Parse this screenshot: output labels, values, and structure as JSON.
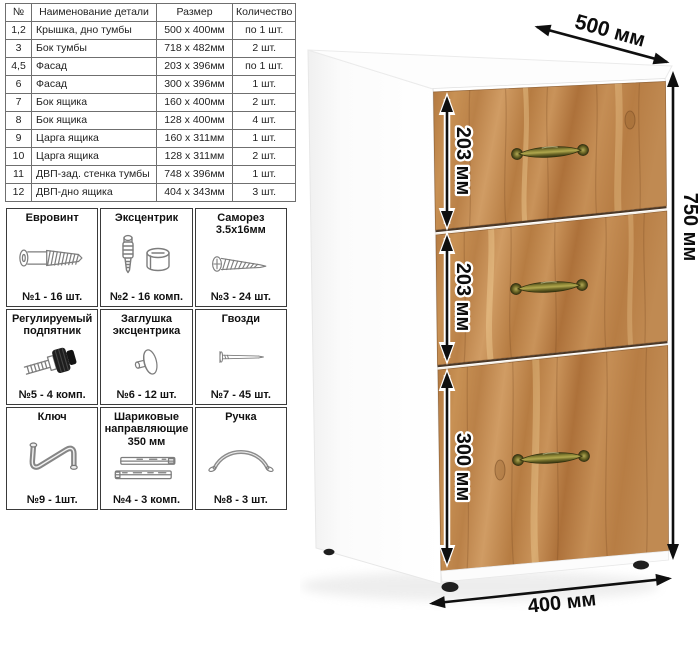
{
  "parts_table": {
    "headers": [
      "№",
      "Наименование детали",
      "Размер",
      "Количество"
    ],
    "rows": [
      [
        "1,2",
        "Крышка, дно тумбы",
        "500 х 400мм",
        "по 1 шт."
      ],
      [
        "3",
        "Бок тумбы",
        "718 х 482мм",
        "2 шт."
      ],
      [
        "4,5",
        "Фасад",
        "203 х 396мм",
        "по 1 шт."
      ],
      [
        "6",
        "Фасад",
        "300 х 396мм",
        "1 шт."
      ],
      [
        "7",
        "Бок ящика",
        "160 х 400мм",
        "2 шт."
      ],
      [
        "8",
        "Бок ящика",
        "128 х 400мм",
        "4 шт."
      ],
      [
        "9",
        "Царга ящика",
        "160 х 311мм",
        "1 шт."
      ],
      [
        "10",
        "Царга ящика",
        "128 х 311мм",
        "2 шт."
      ],
      [
        "11",
        "ДВП-зад. стенка тумбы",
        "748 х 396мм",
        "1 шт."
      ],
      [
        "12",
        "ДВП-дно ящика",
        "404 х 343мм",
        "3 шт."
      ]
    ]
  },
  "hardware": {
    "items": [
      {
        "title": "Евровинт",
        "count": "№1 - 16 шт.",
        "icon": "euro-screw-icon"
      },
      {
        "title": "Эксцентрик",
        "count": "№2 - 16 комп.",
        "icon": "eccentric-cam-icon"
      },
      {
        "title": "Саморез 3.5х16мм",
        "count": "№3 - 24 шт.",
        "icon": "self-tapping-screw-icon"
      },
      {
        "title": "Регулируемый подпятник",
        "count": "№5 - 4 комп.",
        "icon": "adjustable-foot-icon"
      },
      {
        "title": "Заглушка эксцентрика",
        "count": "№6 - 12 шт.",
        "icon": "cam-cap-icon"
      },
      {
        "title": "Гвозди",
        "count": "№7 - 45 шт.",
        "icon": "nail-icon"
      },
      {
        "title": "Ключ",
        "count": "№9 - 1шт.",
        "icon": "hex-key-icon"
      },
      {
        "title": "Шариковые направляющие 350 мм",
        "count": "№4 - 3 комп.",
        "icon": "ball-slides-icon"
      },
      {
        "title": "Ручка",
        "count": "№8 - 3 шт.",
        "icon": "handle-icon"
      }
    ]
  },
  "drawing": {
    "width_label": "500 мм",
    "height_label": "750 мм",
    "depth_label": "400 мм",
    "drawer_labels": [
      "203 мм",
      "203 мм",
      "300 мм"
    ],
    "colors": {
      "wood": "#bd8a52",
      "handle_brass": "#6f6b2c",
      "dimension": "#0c0c0c",
      "cabinet_body": "#ffffff"
    }
  }
}
